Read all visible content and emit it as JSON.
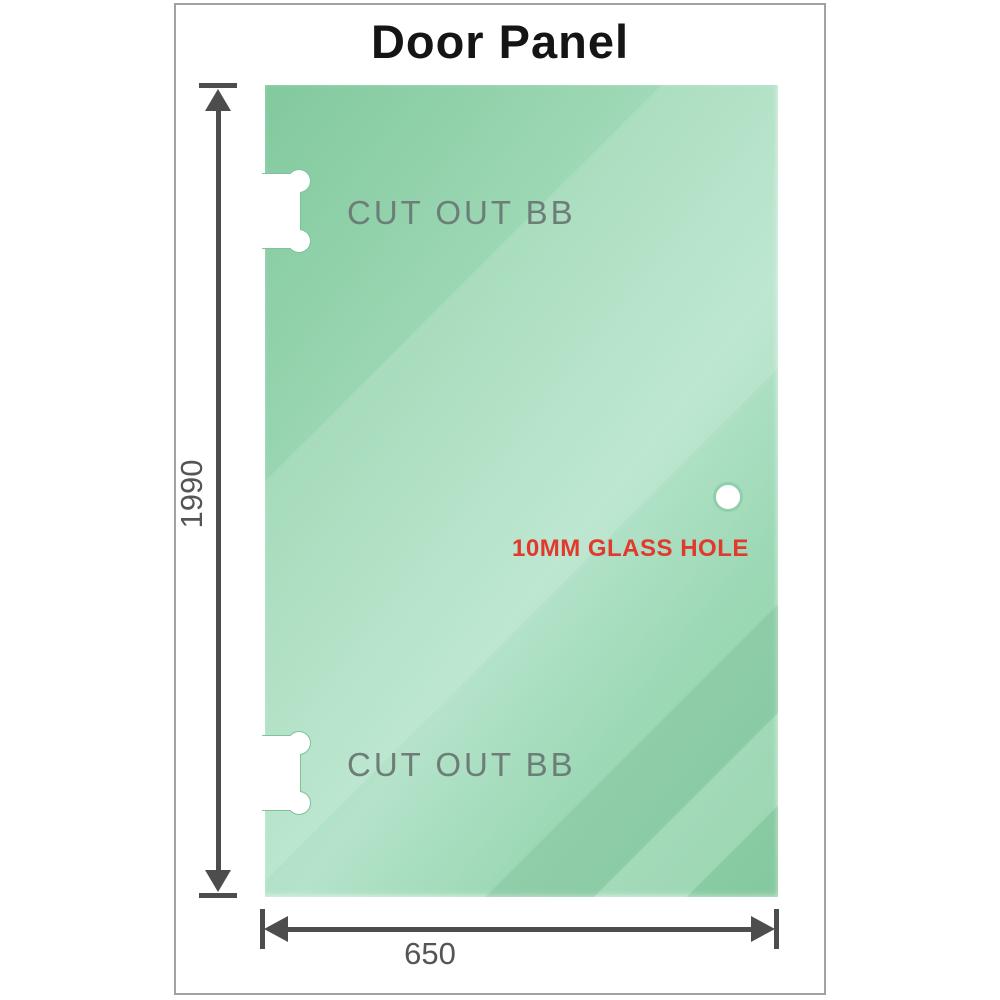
{
  "title": "Door Panel",
  "panel": {
    "cutout_top_label": "CUT OUT BB",
    "cutout_bottom_label": "CUT OUT BB",
    "glass_hole_label": "10MM GLASS HOLE"
  },
  "dimensions": {
    "height_label": "1990",
    "width_label": "650"
  },
  "colors": {
    "glass_green_base": "#9ad6b2",
    "glass_green_light": "#b4e3ca",
    "glass_green_dark": "#82c99e",
    "cutout_fill": "#ffffff",
    "cutout_edge": "#7fc29c",
    "annotation_red": "#e1392d",
    "dimension_gray": "#4d4d4d",
    "dim_label_gray": "#555555",
    "cutout_label_gray": "#6d7d77",
    "frame_border_gray": "#a2a2a2",
    "title_black": "#151515"
  }
}
